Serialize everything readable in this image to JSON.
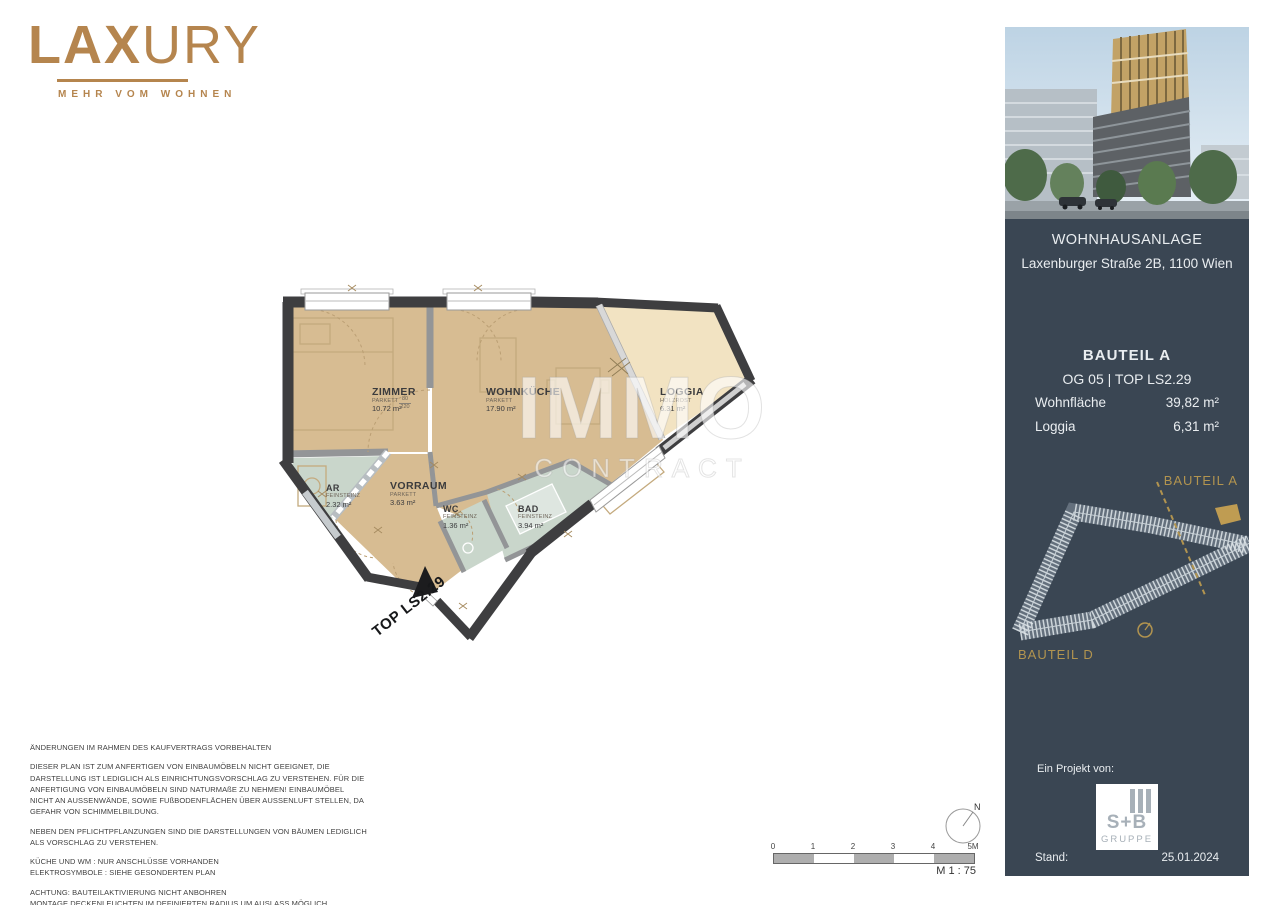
{
  "logo": {
    "brand_bold": "LAX",
    "brand_light": "URY",
    "tagline": "MEHR VOM WOHNEN"
  },
  "plan": {
    "top_label": "TOP LS2.29",
    "door_dim_top": "80",
    "door_dim_bottom": "220",
    "rooms": [
      {
        "name": "ZIMMER",
        "floor": "PARKETT",
        "area": "10.72 m²"
      },
      {
        "name": "WOHNKÜCHE",
        "floor": "PARKETT",
        "area": "17.90 m²"
      },
      {
        "name": "LOGGIA",
        "floor": "HOLZROST",
        "area": "6.31 m²"
      },
      {
        "name": "AR",
        "floor": "FEINSTEINZ",
        "area": "2.32 m²"
      },
      {
        "name": "VORRAUM",
        "floor": "PARKETT",
        "area": "3.63 m²"
      },
      {
        "name": "WC",
        "floor": "FEINSTEINZ",
        "area": "1.36 m²"
      },
      {
        "name": "BAD",
        "floor": "FEINSTEINZ",
        "area": "3.94 m²"
      }
    ],
    "colors": {
      "floor_parquet": "#d7bc92",
      "floor_loggia": "#f2e3c2",
      "floor_tile": "#c9d6cb",
      "wall": "#3e3e40"
    }
  },
  "watermark": {
    "line1": "IMMO",
    "line2": "CONTRACT"
  },
  "sidebar": {
    "project": "WOHNHAUSANLAGE",
    "address": "Laxenburger Straße 2B, 1100 Wien",
    "bauteil": "BAUTEIL A",
    "unit_line": "OG 05 | TOP LS2.29",
    "rows": [
      {
        "label": "Wohnfläche",
        "value": "39,82 m²"
      },
      {
        "label": "Loggia",
        "value": "6,31 m²"
      }
    ],
    "siteplan": {
      "label_a": "BAUTEIL A",
      "label_d": "BAUTEIL D"
    },
    "project_by": "Ein Projekt von:",
    "sb_logo": {
      "name": "S+B",
      "sub": "GRUPPE"
    },
    "stand_label": "Stand:",
    "stand_date": "25.01.2024",
    "accent_gold": "#b2944f",
    "panel_bg": "#3a4653"
  },
  "disclaimer": {
    "paragraphs": [
      "ÄNDERUNGEN IM RAHMEN DES KAUFVERTRAGS VORBEHALTEN",
      "DIESER PLAN IST ZUM ANFERTIGEN VON EINBAUMÖBELN NICHT GEEIGNET, DIE DARSTELLUNG IST LEDIGLICH ALS EINRICHTUNGSVORSCHLAG ZU VERSTEHEN. FÜR DIE ANFERTIGUNG VON EINBAUMÖBELN SIND NATURMAßE ZU NEHMEN! EINBAUMÖBEL NICHT AN AUSSENWÄNDE, SOWIE FUßBODENFLÄCHEN ÜBER AUSSENLUFT STELLEN, DA GEFAHR VON SCHIMMELBILDUNG.",
      "NEBEN DEN PFLICHTPFLANZUNGEN SIND DIE DARSTELLUNGEN VON BÄUMEN LEDIGLICH ALS VORSCHLAG ZU VERSTEHEN.",
      "KÜCHE UND WM : NUR ANSCHLÜSSE VORHANDEN\nELEKTROSYMBOLE : SIEHE GESONDERTEN PLAN",
      "ACHTUNG: BAUTEILAKTIVIERUNG NICHT ANBOHREN\nMONTAGE DECKENLEUCHTEN IM DEFINIERTEN RADIUS UM AUSLASS MÖGLICH"
    ]
  },
  "scalebar": {
    "ticks": [
      "0",
      "1",
      "2",
      "3",
      "4",
      "5M"
    ],
    "scale_label": "M 1 : 75",
    "north": "N"
  }
}
